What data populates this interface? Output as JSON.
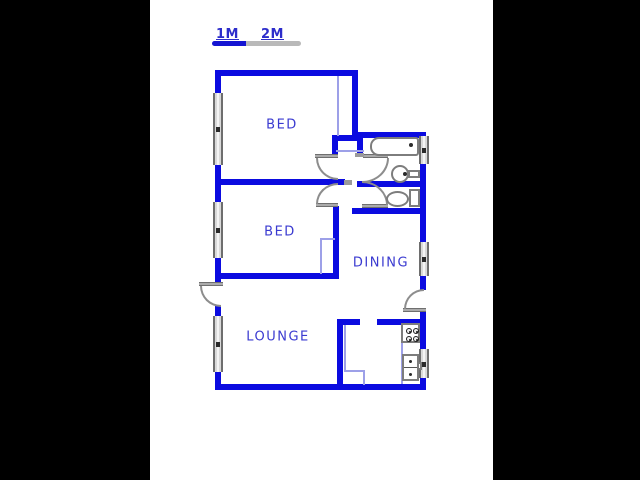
{
  "scale_bar": {
    "label_1m": "1M",
    "label_2m": "2M",
    "filled_color": "#1414d2",
    "empty_color": "#b9b9b9"
  },
  "rooms": [
    {
      "name": "bed-1",
      "label": "BED",
      "cx": 282,
      "cy": 125
    },
    {
      "name": "bed-2",
      "label": "BED",
      "cx": 280,
      "cy": 232
    },
    {
      "name": "dining",
      "label": "DINING",
      "cx": 381,
      "cy": 263
    },
    {
      "name": "lounge",
      "label": "LOUNGE",
      "cx": 278,
      "cy": 337
    }
  ],
  "colors": {
    "wall": "#0b0be0",
    "label": "#3a3ad0",
    "thin_line": "#9da0e8",
    "door": "#8d8d8d",
    "pillar": "#000000",
    "background": "#ffffff"
  },
  "geometry": {
    "pillars": [
      [
        0,
        0,
        150,
        480
      ],
      [
        493,
        0,
        147,
        480
      ]
    ],
    "scale_segments": [
      {
        "rect": [
          212,
          41,
          34,
          5
        ],
        "color": "#1414d2",
        "round": "rl"
      },
      {
        "rect": [
          246,
          41,
          55,
          5
        ],
        "color": "#b9b9b9",
        "round": "rr"
      }
    ],
    "walls": [
      [
        215,
        70,
        143,
        6
      ],
      [
        352,
        70,
        6,
        68
      ],
      [
        352,
        132,
        74,
        6
      ],
      [
        215,
        70,
        6,
        24
      ],
      [
        215,
        164,
        6,
        39
      ],
      [
        215,
        257,
        6,
        26
      ],
      [
        215,
        305,
        6,
        13
      ],
      [
        215,
        371,
        6,
        19
      ],
      [
        215,
        384,
        211,
        6
      ],
      [
        420,
        163,
        6,
        80
      ],
      [
        420,
        275,
        6,
        15
      ],
      [
        420,
        312,
        6,
        38
      ],
      [
        420,
        377,
        6,
        13
      ],
      [
        215,
        179,
        130,
        6
      ],
      [
        332,
        135,
        31,
        6
      ],
      [
        332,
        141,
        6,
        16
      ],
      [
        357,
        141,
        6,
        16
      ],
      [
        357,
        181,
        69,
        6
      ],
      [
        352,
        208,
        74,
        6
      ],
      [
        333,
        206,
        6,
        73
      ],
      [
        215,
        273,
        124,
        6
      ],
      [
        337,
        319,
        23,
        6
      ],
      [
        377,
        319,
        49,
        6
      ],
      [
        337,
        319,
        6,
        71
      ]
    ],
    "windows": [
      {
        "name": "window-bed1-left",
        "rect": [
          213,
          93,
          10,
          72
        ]
      },
      {
        "name": "window-bed2-left",
        "rect": [
          213,
          202,
          10,
          56
        ]
      },
      {
        "name": "window-lounge-left",
        "rect": [
          213,
          316,
          10,
          56
        ]
      },
      {
        "name": "window-bath-right",
        "rect": [
          419,
          136,
          10,
          28
        ]
      },
      {
        "name": "window-dining-right",
        "rect": [
          419,
          242,
          10,
          34
        ]
      },
      {
        "name": "window-kitchen-right",
        "rect": [
          419,
          349,
          10,
          29
        ]
      }
    ],
    "thin_lines": [
      [
        337,
        76,
        2,
        60
      ],
      [
        336,
        150,
        28,
        2
      ],
      [
        320,
        238,
        2,
        36
      ],
      [
        320,
        238,
        15,
        2
      ],
      [
        344,
        325,
        2,
        47
      ],
      [
        344,
        370,
        21,
        2
      ],
      [
        363,
        370,
        2,
        15
      ],
      [
        401,
        325,
        2,
        59
      ]
    ],
    "doors": [
      {
        "name": "entrance-door",
        "leaf": [
          199,
          282,
          24,
          4
        ],
        "arc": [
          200,
          286,
          21,
          21
        ],
        "corner": "bl"
      },
      {
        "name": "bed1-door",
        "leaf": [
          315,
          154,
          23,
          4
        ],
        "arc": [
          316,
          158,
          22,
          22
        ],
        "corner": "bl"
      },
      {
        "name": "bathroom-door",
        "leaf": [
          363,
          154,
          25,
          4
        ],
        "arc": [
          362,
          158,
          27,
          25
        ],
        "corner": "br"
      },
      {
        "name": "wc-door",
        "leaf": [
          362,
          204,
          26,
          4
        ],
        "arc": [
          362,
          181,
          26,
          24
        ],
        "corner": "tr"
      },
      {
        "name": "bed2-door",
        "leaf": [
          316,
          203,
          22,
          4
        ],
        "arc": [
          316,
          183,
          22,
          21
        ],
        "corner": "tl"
      },
      {
        "name": "backdoor-dining",
        "leaf": [
          403,
          308,
          23,
          4
        ],
        "arc": [
          404,
          289,
          20,
          20
        ],
        "corner": "tl"
      }
    ],
    "caps": [
      [
        355,
        153,
        9,
        4
      ],
      [
        344,
        180,
        8,
        5
      ]
    ],
    "fixtures": [
      {
        "type": "tub",
        "name": "bathtub",
        "rect": [
          370,
          137,
          49,
          19
        ]
      },
      {
        "type": "dot",
        "name": "bathtub-drain",
        "rect": [
          409,
          143,
          4,
          4
        ]
      },
      {
        "type": "circle",
        "name": "bath-sink",
        "rect": [
          391,
          165,
          18,
          18
        ]
      },
      {
        "type": "rect",
        "name": "bath-sink-tap",
        "rect": [
          408,
          170,
          12,
          8
        ]
      },
      {
        "type": "dot",
        "name": "bath-sink-drain",
        "rect": [
          403,
          172,
          4,
          4
        ]
      },
      {
        "type": "rect",
        "name": "toilet-tank",
        "rect": [
          409,
          189,
          11,
          18
        ]
      },
      {
        "type": "circle",
        "name": "toilet-bowl",
        "rect": [
          386,
          191,
          23,
          16
        ]
      },
      {
        "type": "stove",
        "name": "stove",
        "rect": [
          401,
          323,
          19,
          20
        ]
      },
      {
        "type": "ksink",
        "name": "kitchen-sink",
        "rect": [
          402,
          354,
          17,
          27
        ]
      },
      {
        "type": "rect",
        "name": "kitchen-tap",
        "rect": [
          417,
          362,
          5,
          8
        ]
      }
    ]
  }
}
